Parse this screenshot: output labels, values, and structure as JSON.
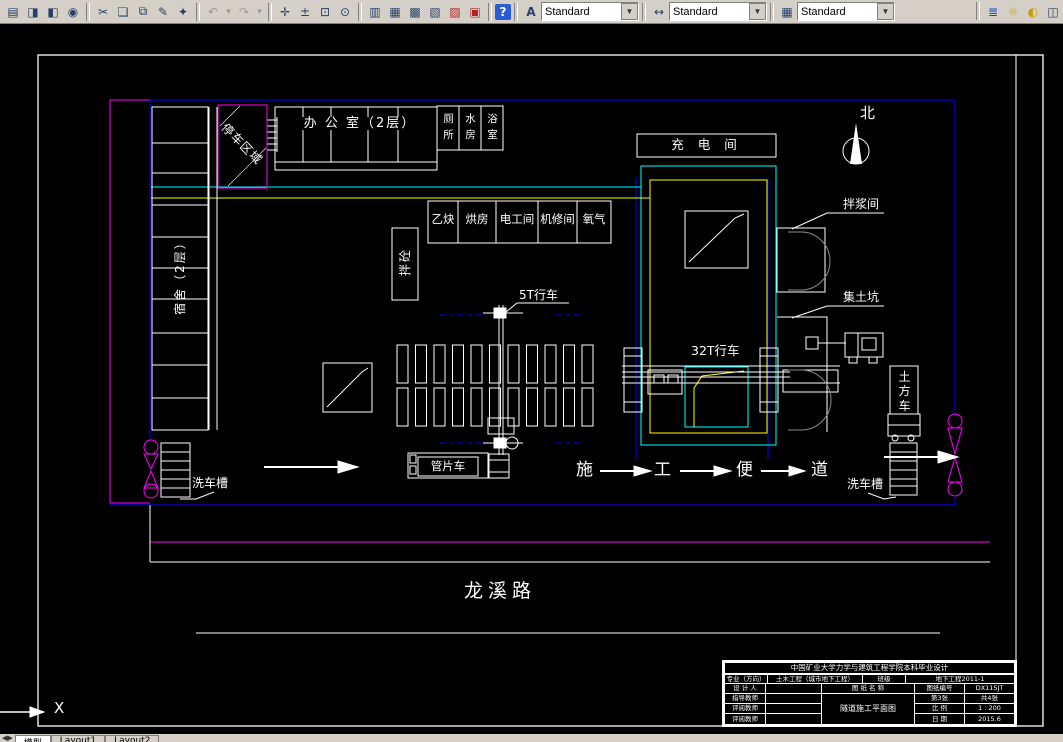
{
  "toolbar": {
    "icons": {
      "plot": "▤",
      "preview": "◨",
      "publish": "◧",
      "web": "◉",
      "cut": "✂",
      "copy": "❏",
      "paste": "⧉",
      "brush": "✎",
      "match": "✦",
      "undo": "↶",
      "undo_more": "▾",
      "redo": "↷",
      "redo_more": "▾",
      "pan": "✛",
      "zoom_realtime": "±",
      "zoom_window": "⊡",
      "zoom_previous": "⊙",
      "properties": "▥",
      "design_center": "▦",
      "tool_palettes": "▩",
      "sheet_set": "▧",
      "markup": "▨",
      "calculator": "▣",
      "help": "?",
      "text_style": "A",
      "dim_style": "↔",
      "table_style": "▦",
      "layers": "≣",
      "bulb": "☼",
      "sun": "◐",
      "xref": "◫"
    },
    "text_style_value": "Standard",
    "dim_style_value": "Standard",
    "table_style_value": "Standard",
    "dropdown_glyph": "▼"
  },
  "plan": {
    "parking": "停车区域",
    "dorm": "宿舍（2层）",
    "office": "办 公 室（2层）",
    "toilet": "厕所",
    "water": "水房",
    "bath": "浴室",
    "acetylene": "乙炔",
    "drying": "烘房",
    "electric": "电工间",
    "repair": "机修间",
    "oxygen": "氧气",
    "mixing": "拌砼",
    "charging": "充 电 间",
    "north": "北",
    "slurry": "拌浆间",
    "soil_pit": "集土坑",
    "crane5": "5T行车",
    "crane32": "32T行车",
    "wash_left": "洗车槽",
    "wash_right": "洗车槽",
    "segment_truck": "管片车",
    "earth_truck": "土方车",
    "road_char1": "施",
    "road_char2": "工",
    "road_char3": "便",
    "road_char4": "道",
    "street": "龙溪路",
    "ucs_x": "X"
  },
  "title_block": {
    "header": "中国矿业大学力学与建筑工程学院本科毕业设计",
    "major_label": "专业（方向）",
    "major_value": "土木工程（城市地下工程）",
    "class_label": "班级",
    "class_value": "地下工程2011-1",
    "designer_label": "设 计 人",
    "advisor_label": "指导教师",
    "reviewer1_label": "评阅教师",
    "reviewer2_label": "评阅教师",
    "drawing_name_label": "图 纸 名 称",
    "drawing_name": "隧道施工平面图",
    "drawing_no_label": "图纸编号",
    "drawing_no": "DX115JT",
    "sheet": "第3张",
    "sheets_total": "共4张",
    "scale_label": "比  例",
    "scale_value": "1 : 200",
    "date_label": "日  期",
    "date_value": "2015.6"
  },
  "tabs": {
    "model": "模型",
    "layout1": "Layout1",
    "layout2": "Layout2"
  },
  "colors": {
    "toolbar_bg": "#d4d0c8",
    "canvas": "#000000",
    "line_white": "#ffffff",
    "boundary_magenta": "#ff00ff",
    "fence_blue": "#0000ff",
    "pit_cyan": "#00ffff",
    "pit_yellow": "#ffff00",
    "tunnel_gray": "#8c8c8c"
  }
}
